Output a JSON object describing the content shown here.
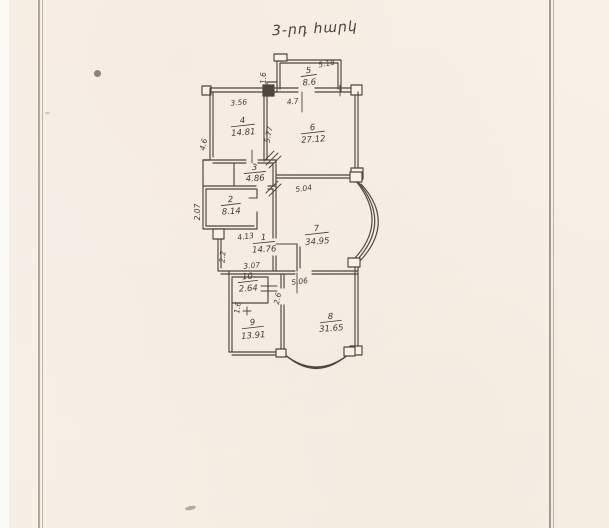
{
  "page": {
    "handwritten_title": "3-րդ հարկ",
    "paper_color": "#f7f1e8",
    "ink_color": "#4d463d"
  },
  "plan": {
    "rooms": [
      {
        "number": "5",
        "area": "8.6"
      },
      {
        "number": "4",
        "area": "14.81"
      },
      {
        "number": "6",
        "area": "27.12"
      },
      {
        "number": "3",
        "area": "4.86"
      },
      {
        "number": "2",
        "area": "8.14"
      },
      {
        "number": "7",
        "area": "34.95"
      },
      {
        "number": "1",
        "area": "14.76"
      },
      {
        "number": "10",
        "area": "2.64"
      },
      {
        "number": "9",
        "area": "13.91"
      },
      {
        "number": "8",
        "area": "31.65"
      }
    ],
    "dimensions": [
      "5.18",
      "1.6",
      "4.7",
      "3.56",
      "4.6",
      "5.77",
      "5.04",
      "2.07",
      "4.13",
      "2.2",
      "3.07",
      "5.06",
      "2.6",
      "1.6"
    ]
  }
}
